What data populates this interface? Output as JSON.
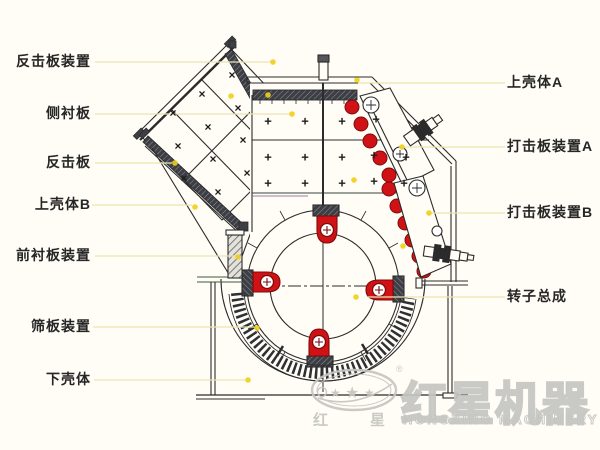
{
  "page": {
    "background": "#fffdf6",
    "type": "impact-crusher-structure-diagram"
  },
  "colors": {
    "line": "#2b2b2b",
    "red": "#d01217",
    "red_dark": "#7c0b0b",
    "leader_line": "#ece4b4",
    "dot": "#f0cf1b",
    "watermark": "#c5c5c1",
    "label_text": "#262626"
  },
  "annotations": {
    "left": [
      {
        "label": "反击板装置",
        "y": 62,
        "x1": 95,
        "x2": 273
      },
      {
        "label": "侧衬板",
        "y": 114,
        "x1": 95,
        "x2": 290
      },
      {
        "label": "反击板",
        "y": 163,
        "x1": 95,
        "x2": 172
      },
      {
        "label": "上壳体B",
        "y": 205,
        "x1": 92,
        "x2": 192
      },
      {
        "label": "前衬板装置",
        "y": 256,
        "x1": 95,
        "x2": 236
      },
      {
        "label": "筛板装置",
        "y": 327,
        "x1": 93,
        "x2": 254
      },
      {
        "label": "下壳体",
        "y": 380,
        "x1": 94,
        "x2": 245
      }
    ],
    "right": [
      {
        "label": "上壳体A",
        "y": 83,
        "x1": 358,
        "x2": 505
      },
      {
        "label": "打击板装置A",
        "y": 147,
        "x1": 400,
        "x2": 505
      },
      {
        "label": "打击板装置B",
        "y": 213,
        "x1": 427,
        "x2": 505
      },
      {
        "label": "转子总成",
        "y": 297,
        "x1": 368,
        "x2": 505
      }
    ]
  },
  "dots": [
    [
      273,
      62
    ],
    [
      292,
      114
    ],
    [
      175,
      163
    ],
    [
      195,
      207
    ],
    [
      238,
      257
    ],
    [
      257,
      328
    ],
    [
      248,
      380
    ],
    [
      357,
      80
    ],
    [
      268,
      95
    ],
    [
      231,
      96
    ],
    [
      354,
      180
    ],
    [
      403,
      246
    ],
    [
      356,
      297
    ],
    [
      429,
      213
    ],
    [
      402,
      147
    ]
  ],
  "marks": {
    "plus": [
      [
        268,
        122
      ],
      [
        305,
        122
      ],
      [
        342,
        122
      ],
      [
        376,
        120
      ],
      [
        268,
        158
      ],
      [
        305,
        158
      ],
      [
        342,
        158
      ],
      [
        374,
        156
      ],
      [
        406,
        158
      ],
      [
        268,
        184
      ],
      [
        305,
        184
      ],
      [
        342,
        184
      ],
      [
        374,
        182
      ],
      [
        404,
        184
      ]
    ],
    "cross": [
      [
        232,
        76
      ],
      [
        202,
        95
      ],
      [
        173,
        114
      ],
      [
        238,
        109
      ],
      [
        208,
        128
      ],
      [
        178,
        147
      ],
      [
        243,
        141
      ],
      [
        213,
        160
      ],
      [
        184,
        179
      ],
      [
        247,
        174
      ],
      [
        218,
        193
      ]
    ]
  },
  "glyphs": {
    "plus": "+",
    "cross": "×",
    "star": "★"
  },
  "watermark": {
    "brand_cn": "红星机器",
    "brand_en": "HONGXING MACHINERY",
    "emblem_cn_left": "红",
    "emblem_cn_right": "星",
    "registered": "®"
  }
}
